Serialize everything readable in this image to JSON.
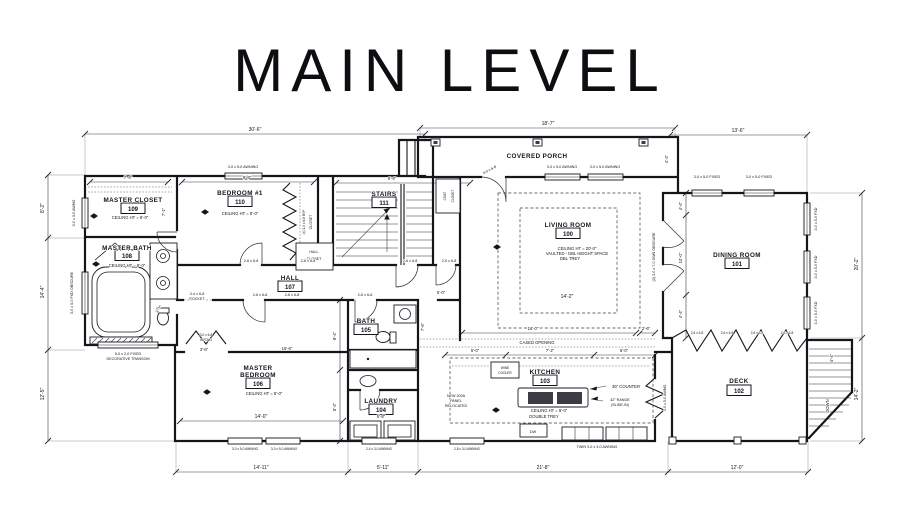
{
  "title": "MAIN LEVEL",
  "colors": {
    "ink": "#15151c",
    "paper": "#ffffff"
  },
  "rooms": {
    "living": {
      "name": "LIVING ROOM",
      "number": "100",
      "note1": "CEILING HT = 20'-0\"",
      "note2": "VAULTED - DBL HEIGHT SPACE",
      "note3": "DBL TREY",
      "width": "14'-2\""
    },
    "dining": {
      "name": "DINING ROOM",
      "number": "101"
    },
    "deck": {
      "name": "DECK",
      "number": "102"
    },
    "kitchen": {
      "name": "KITCHEN",
      "number": "103",
      "note1": "CEILING HT = 9'-0\"",
      "note2": "DOUBLE TREY"
    },
    "laundry": {
      "name": "LAUNDRY",
      "number": "104",
      "width": "5'-8\""
    },
    "bath": {
      "name": "BATH",
      "number": "105"
    },
    "master_bedroom": {
      "line1": "MASTER",
      "line2": "BEDROOM",
      "number": "106",
      "note": "CEILING HT = 8'-0\"",
      "width": "14'-0\"",
      "top": "16'-6\""
    },
    "hall": {
      "name": "HALL",
      "number": "107",
      "dim": "5'-0\""
    },
    "master_bath": {
      "name": "MASTER BATH",
      "number": "108",
      "note": "CEILING HT = 9'-0\""
    },
    "master_closet": {
      "name": "MASTER CLOSET",
      "number": "109",
      "note": "CEILING HT = 8'-0\""
    },
    "bedroom1": {
      "name": "BEDROOM #1",
      "number": "110",
      "note": "CEILING HT = 8'-0\""
    },
    "stairs": {
      "name": "STAIRS",
      "number": "111"
    },
    "porch": {
      "name": "COVERED PORCH"
    },
    "hall_closet": {
      "line1": "HALL",
      "line2": "CLOSET"
    },
    "coat_closet": {
      "line1": "COAT",
      "line2": "CLOSET"
    },
    "bedroom_closet": {
      "label": "CLOSET",
      "doors": "(4) 1-9 x 6-8 BYP"
    }
  },
  "dims": {
    "top_left": "30'-6\"",
    "top_mid": "18'-7\"",
    "top_right": "13'-6\"",
    "left1": "8'-2\"",
    "left2": "14'-4\"",
    "left3": "12'-5\"",
    "right1": "20'-2\"",
    "right2": "14'-2\"",
    "bottom1": "14'-11\"",
    "bottom2": "5'-11\"",
    "bottom3": "21'-8\"",
    "bottom4": "12'-0\"",
    "closet_top": "7'-9\"",
    "bed1_top": "9'-9\"",
    "stairs_top": "9'-9\"",
    "closet_side": "7'-1\"",
    "porch_depth": "4'-4\"",
    "din1": "4'-4\"",
    "din2": "10'-0\"",
    "din3": "4'-4\"",
    "liv_bottom": "16'-0\"",
    "liv_off": "2'-6\"",
    "kit1": "5'-0\"",
    "kit2": "7'-2\"",
    "kit3": "5'-0\"",
    "mbr_r1": "8'-4\"",
    "mbr_r2": "8'-4\"",
    "bifold": "3'-6\"",
    "pocket": "3'-7\"",
    "bath_side": "7'-6\"",
    "deck_stair": "4'-4\""
  },
  "openings": {
    "awn_3050": "3-0 x 5-0 AWNING",
    "fixed_3050": "3-0 x 5-0 FIXED",
    "fxd_3050": "3-0 x 5-0 FXD",
    "awng_3030": "3-0 x 3-0 AWNG",
    "fxd_obscure": "3-0 x 5-0 FXD OBSCURE",
    "transom1": "5-0 x 2-0 FIXED",
    "transom2": "DECORATIVE TRANSOM",
    "awn_2430": "2-4 x 3-0 AWNING",
    "awn_2830": "2-8 x 3-0 AWNING",
    "twin_awn": "TWIN 3-0 x 3-0 AWNING",
    "door_3068": "3-0 x 6-8",
    "door_2668": "2-6 x 6-8",
    "door_2068": "2-0 x 6-8",
    "pocket1": "3-4 x 6-8",
    "pocket2": "POCKET",
    "bifold1": "3-0 x 6-8",
    "bifold2": "BIFOLD",
    "swn_doors": "(2) 3-0 x 7-0 SWN OBSCURE",
    "kit_awng": "3-0 x 5-0 AWNG"
  },
  "notes": {
    "cased_opening": "CASED OPENING",
    "panel1": "NEW 200A",
    "panel2": "PANEL",
    "panel3": "RELOCATED",
    "counter": "36\" COUNTER",
    "range1": "42\" RANGE",
    "range2": "(SLIDE-IN)",
    "wine1": "WINE",
    "wine2": "COOLER",
    "dw": "DW",
    "down": "DOWN"
  }
}
